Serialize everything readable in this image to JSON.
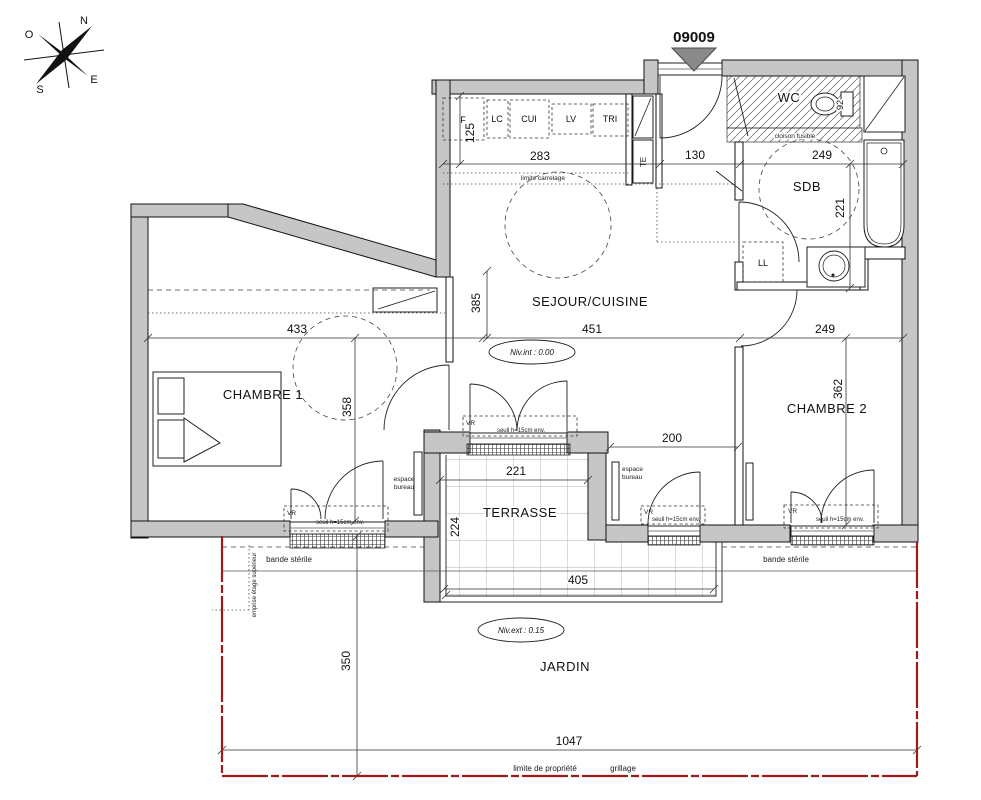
{
  "plan": {
    "unit_number": "09009",
    "compass": {
      "n": "N",
      "o": "O",
      "e": "E",
      "s": "S"
    },
    "rooms": {
      "wc": "WC",
      "sdb": "SDB",
      "sejour_cuisine": "SEJOUR/CUISINE",
      "chambre1": "CHAMBRE 1",
      "chambre2": "CHAMBRE 2",
      "terrasse": "TERRASSE",
      "jardin": "JARDIN"
    },
    "equipment": {
      "f": "F",
      "lc": "LC",
      "cui": "CUI",
      "lv": "LV",
      "tri": "TRI",
      "te": "TE",
      "ll": "LL"
    },
    "levels": {
      "interior": "Niv.int : 0.00",
      "exterior": "Niv.ext : 0.15"
    },
    "annotations": {
      "limite_carrelage": "limite carrelage",
      "cloison_fusible": "cloison fusible",
      "bande_sterile": "bande stérile",
      "emprise_etage": "emprise étage supérieur",
      "espace": "espace",
      "bureau": "bureau",
      "vr": "VR",
      "seuil": "seuil h=15cm env.",
      "limite_propriete": "limite de propriété",
      "grillage": "grillage",
      "wc_width": "92"
    },
    "dimensions": {
      "cuisine_depth": "125",
      "cuisine_width": "283",
      "hall_width": "130",
      "sdb_width": "249",
      "sdb_depth": "221",
      "sejour_depth": "385",
      "sejour_width": "451",
      "chambre1_width": "433",
      "chambre1_depth": "358",
      "chambre2_width": "249",
      "chambre2_depth": "362",
      "mur_chambre2": "200",
      "terrasse_top_width": "221",
      "terrasse_depth": "224",
      "terrasse_width": "405",
      "jardin_depth": "350",
      "jardin_width": "1047"
    },
    "colors": {
      "wall": "#c6c6c6",
      "line": "#1a1a1a",
      "property_line": "#9b1b1b",
      "entry_marker": "#8a8a8a"
    }
  }
}
